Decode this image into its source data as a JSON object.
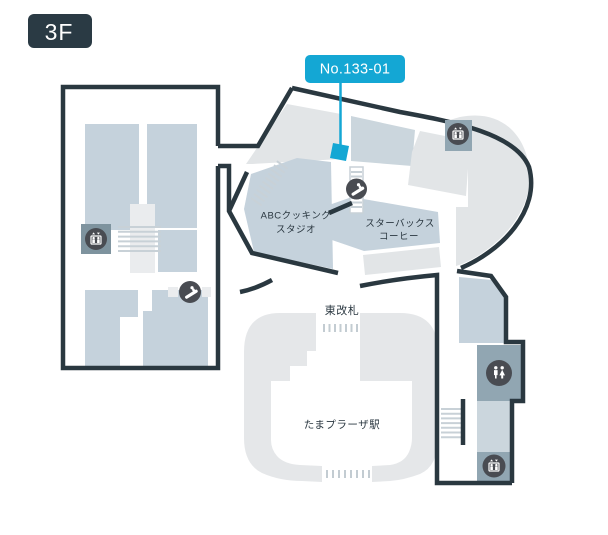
{
  "page": {
    "floor_badge": "3F"
  },
  "marker": {
    "label": "No.133-01"
  },
  "labels": {
    "abc_line1": "ABCクッキング",
    "abc_line2": "スタジオ",
    "starbucks_line1": "スターバックス",
    "starbucks_line2": "コーヒー",
    "east_gate": "東改札",
    "station": "たまプラーザ駅"
  },
  "icons": [
    "elevator-icon",
    "escalator-icon",
    "restroom-icon"
  ],
  "colors": {
    "wall": "#2A3840",
    "accent_cyan": "#14A7D4",
    "room_blue": "#C5D2DC",
    "room_blue_light": "#CBD6DD",
    "area_gray": "#E2E5E7",
    "area_gray_light": "#EAECEE",
    "station_gray": "#E5E7E9",
    "icon_square": "#91A6B2",
    "icon_square_dark": "#7E939E",
    "icon_circle": "#494C52",
    "stair_line": "#C8D1D7",
    "gate_dash": "#C3CCD2",
    "text_dark": "#2A3740",
    "badge_bg": "#2A3A44",
    "label_text": "#FFFFFF"
  }
}
